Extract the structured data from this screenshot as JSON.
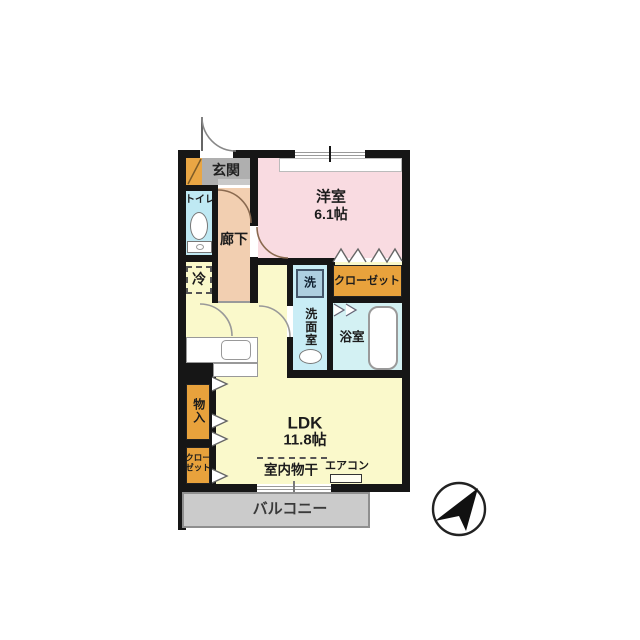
{
  "plan": {
    "labels": {
      "entrance": "玄関",
      "toilet": "トイレ",
      "hallway": "廊下",
      "western_room": "洋室",
      "western_room_size": "6.1帖",
      "closet": "クローゼット",
      "washer": "洗",
      "washroom": "洗面室",
      "bathroom": "浴室",
      "refrigerator": "冷",
      "ldk": "LDK",
      "ldk_size": "11.8帖",
      "storage": "物入",
      "closet_left_line1": "クロー",
      "closet_left_line2": "ゼット",
      "indoor_drying": "室内物干",
      "aircon": "エアコン",
      "balcony": "バルコニー"
    },
    "colors": {
      "wall": "#161616",
      "ldk_floor": "#faf9cb",
      "western_room_floor": "#f9dbe1",
      "hallway_floor": "#f2cfb1",
      "entrance_floor": "#afafaf",
      "toilet_floor": "#bfe9f3",
      "washroom_floor": "#c9edf6",
      "bathroom_floor": "#d3f1f3",
      "closet_fill": "#e8a23c",
      "balcony_fill": "#cbcbcb"
    }
  }
}
